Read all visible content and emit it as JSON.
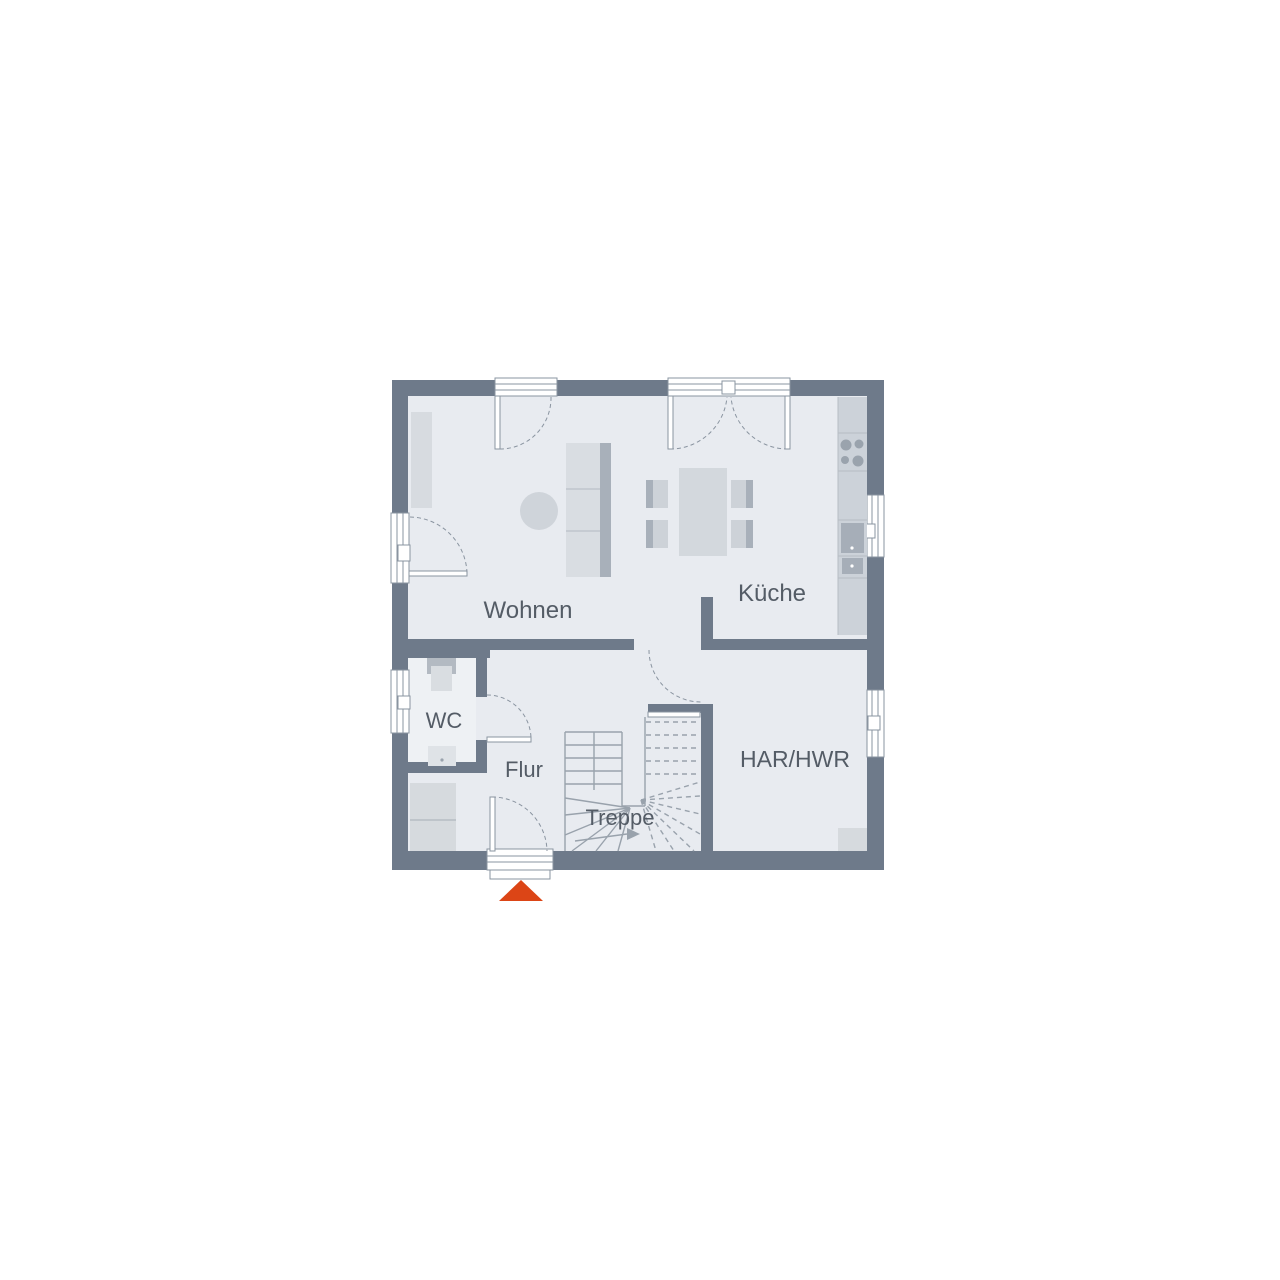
{
  "plan": {
    "type": "floor-plan",
    "rooms": [
      {
        "id": "wohnen",
        "label": "Wohnen"
      },
      {
        "id": "kueche",
        "label": "Küche"
      },
      {
        "id": "wc",
        "label": "WC"
      },
      {
        "id": "flur",
        "label": "Flur"
      },
      {
        "id": "treppe",
        "label": "Treppe"
      },
      {
        "id": "har_hwr",
        "label": "HAR/HWR"
      }
    ],
    "colors": {
      "wall": "#6e7a8a",
      "floor": "#e8ebf0",
      "floor_light": "#eef1f4",
      "furniture_light": "#d7dbe0",
      "furniture_medium": "#ccd2d9",
      "furniture_dark": "#a8b0ba",
      "fixture_line": "#99a2ac",
      "text": "#545c66",
      "entrance_accent": "#dc4516"
    },
    "markers": {
      "entrance": "entrance-arrow"
    }
  }
}
